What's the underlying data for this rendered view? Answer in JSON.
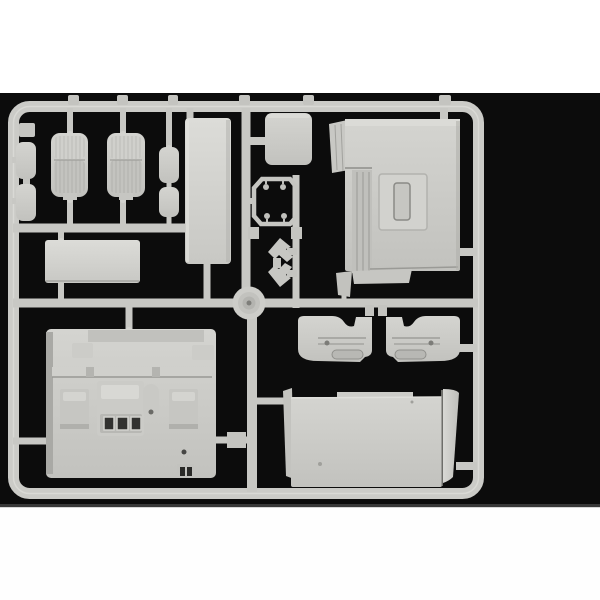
{
  "scene": {
    "type": "product-photograph",
    "subject": "Light gray injection-molded plastic model kit sprue (parts tree) of truck cab interior parts, photographed on a black backdrop with white bands at top and bottom",
    "colors": {
      "band_top": "#ffffff",
      "band_bottom": "#ffffff",
      "backdrop": "#0c0c0c",
      "plastic_base": "#c9c9c5",
      "plastic_light": "#dcdcd8",
      "plastic_mid": "#b8b8b4",
      "plastic_shadow": "#8a8a86",
      "slot_dark": "#2e2e2c"
    }
  },
  "parts": [
    {
      "label": "Sprue outer frame"
    },
    {
      "label": "Runner rails and connector stubs"
    },
    {
      "label": "Injection point hub"
    },
    {
      "label": "Truck seat (left)"
    },
    {
      "label": "Truck seat (right)"
    },
    {
      "label": "Small pad part (left upper)"
    },
    {
      "label": "Small pad part (left lower)"
    },
    {
      "label": "Small pad part (middle upper)"
    },
    {
      "label": "Small pad part (middle lower)"
    },
    {
      "label": "Small clip nub on left rail"
    },
    {
      "label": "Tall rectangular panel"
    },
    {
      "label": "Square panel"
    },
    {
      "label": "Hatch frame with corner pins"
    },
    {
      "label": "Arrow-shaped bracket (upper)"
    },
    {
      "label": "Arrow-shaped bracket (lower)"
    },
    {
      "label": "Flat rectangular plate"
    },
    {
      "label": "Cab floor with engine cover and seat pedestals"
    },
    {
      "label": "Door interior panel (left)"
    },
    {
      "label": "Door interior panel (right)"
    },
    {
      "label": "Rear cab wall panel"
    },
    {
      "label": "Front cab panel"
    }
  ]
}
